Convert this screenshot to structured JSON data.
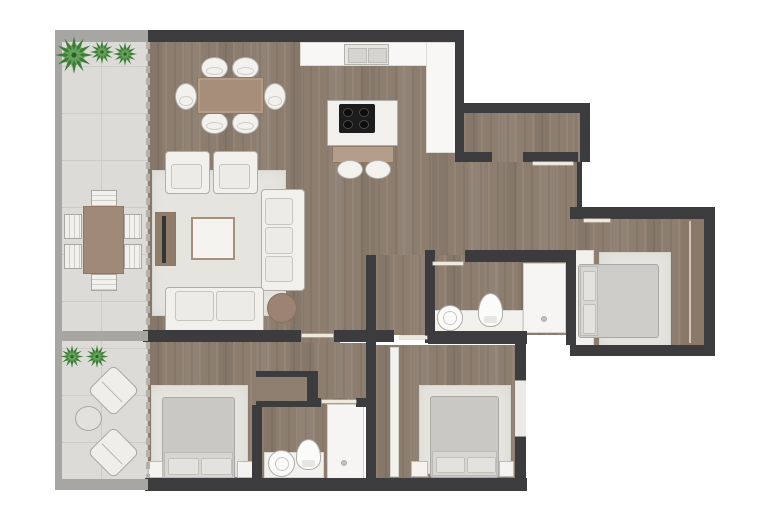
{
  "plan": {
    "type": "apartment-floor-plan",
    "palette": {
      "interior_wall": "#3c3c3e",
      "terrace_wall": "#a8a6a2",
      "wood_floor": "#8c7d6f",
      "terrace_tile": "#dcdbd7",
      "rug": "#e6e4df",
      "furniture_white": "#f1f0ed",
      "furniture_brown": "#a78e7b",
      "bed_gray": "#c9c8c5",
      "plant_green_dark": "#3e7d39",
      "plant_green_light": "#66a35a",
      "cooktop_black": "#1c1c1c"
    },
    "rooms": [
      {
        "name": "terrace-upper",
        "floor": "tile",
        "items": [
          {
            "item": "plant",
            "count": 3
          },
          {
            "item": "outdoor-dining-table",
            "count": 1
          },
          {
            "item": "outdoor-chair",
            "count": 6
          }
        ]
      },
      {
        "name": "terrace-lower",
        "floor": "tile",
        "items": [
          {
            "item": "plant",
            "count": 2
          },
          {
            "item": "lounge-chair",
            "count": 2
          },
          {
            "item": "side-table",
            "count": 1
          }
        ]
      },
      {
        "name": "living-dining-room",
        "floor": "wood",
        "items": [
          {
            "item": "dining-table",
            "count": 1
          },
          {
            "item": "dining-chair",
            "count": 6
          },
          {
            "item": "rug",
            "count": 1
          },
          {
            "item": "armchair",
            "count": 2
          },
          {
            "item": "sofa",
            "count": 1
          },
          {
            "item": "loveseat",
            "count": 1
          },
          {
            "item": "coffee-table",
            "count": 1
          },
          {
            "item": "tv-console",
            "count": 1
          },
          {
            "item": "tv",
            "count": 1
          },
          {
            "item": "pouf",
            "count": 1
          }
        ]
      },
      {
        "name": "kitchen",
        "floor": "wood",
        "items": [
          {
            "item": "counter",
            "count": 2
          },
          {
            "item": "double-sink",
            "count": 1
          },
          {
            "item": "island",
            "count": 1
          },
          {
            "item": "cooktop",
            "count": 1
          },
          {
            "item": "bar-stool",
            "count": 2
          }
        ]
      },
      {
        "name": "entry-hall",
        "floor": "wood",
        "items": []
      },
      {
        "name": "bathroom-main",
        "floor": "wood",
        "items": [
          {
            "item": "washbasin",
            "count": 1
          },
          {
            "item": "toilet",
            "count": 1
          },
          {
            "item": "shower",
            "count": 1
          },
          {
            "item": "vanity-counter",
            "count": 1
          }
        ]
      },
      {
        "name": "bathroom-second",
        "floor": "wood",
        "items": [
          {
            "item": "washbasin",
            "count": 1
          },
          {
            "item": "toilet",
            "count": 1
          },
          {
            "item": "shower",
            "count": 1
          },
          {
            "item": "vanity-counter",
            "count": 1
          }
        ]
      },
      {
        "name": "bedroom-left",
        "floor": "wood",
        "items": [
          {
            "item": "double-bed",
            "count": 1
          },
          {
            "item": "rug",
            "count": 1
          },
          {
            "item": "nightstand",
            "count": 2
          },
          {
            "item": "closet",
            "count": 1
          }
        ]
      },
      {
        "name": "bedroom-middle",
        "floor": "wood",
        "items": [
          {
            "item": "double-bed",
            "count": 1
          },
          {
            "item": "rug",
            "count": 1
          },
          {
            "item": "nightstand",
            "count": 2
          },
          {
            "item": "wardrobe",
            "count": 1
          }
        ]
      },
      {
        "name": "bedroom-right",
        "floor": "wood",
        "items": [
          {
            "item": "double-bed",
            "count": 1
          },
          {
            "item": "rug",
            "count": 1
          },
          {
            "item": "wardrobe",
            "count": 1
          },
          {
            "item": "closet",
            "count": 1
          }
        ]
      }
    ]
  }
}
